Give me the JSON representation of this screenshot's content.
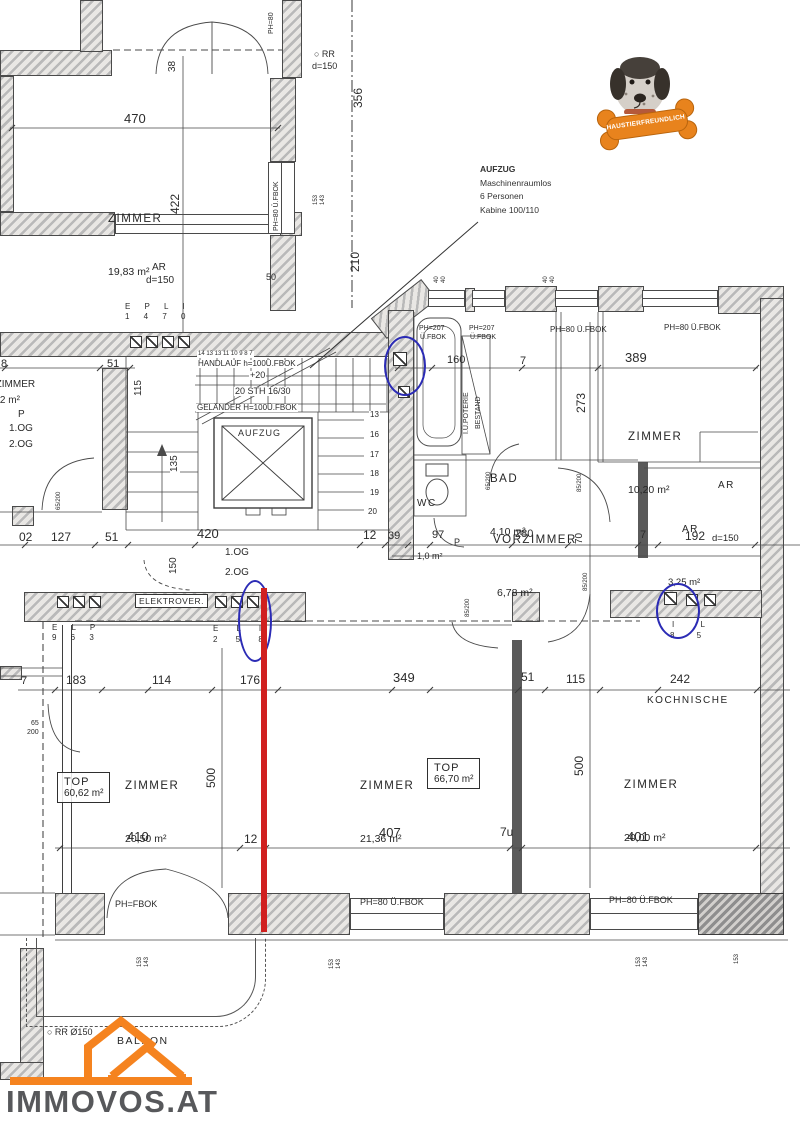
{
  "logo": {
    "text": "IMMOVOS.AT"
  },
  "badge": {
    "text": "HAUSTIERFREUNDLICH"
  },
  "note": {
    "l1": "AUFZUG",
    "l2": "Maschinenraumlos",
    "l3": "6 Personen",
    "l4": "Kabine 100/110"
  },
  "colors": {
    "highlight_red": "#d0201f",
    "circle_blue": "#2b2bb5",
    "logo_orange": "#f5831f",
    "logo_gray": "#57585b",
    "bone_orange": "#e8831d"
  },
  "rooms": {
    "zimmer_tl": {
      "name": "ZIMMER",
      "area": "19,83 m²"
    },
    "zimmer_r": {
      "name": "ZIMMER",
      "area": "10,20 m²"
    },
    "bad": {
      "name": "BAD",
      "area": "4,10 m²"
    },
    "wc": {
      "name": "WC",
      "area": "1,0 m²"
    },
    "vorzimmer": {
      "name": "VORZIMMER",
      "area": "6,78 m²"
    },
    "ar_top": {
      "name": "AR",
      "area": "d=150"
    },
    "ar_mid": {
      "name": "AR",
      "area": "3,25 m²"
    },
    "kochnische": {
      "name": "KOCHNISCHE"
    },
    "zimmer_bl": {
      "name": "ZIMMER",
      "area": "20,50 m²"
    },
    "top_unit_left": {
      "name": "TOP",
      "area": "60,62 m²"
    },
    "zimmer_bc": {
      "name": "ZIMMER",
      "area": "21,36 m²"
    },
    "top_unit_right": {
      "name": "TOP",
      "area": "66,70 m²"
    },
    "zimmer_br": {
      "name": "ZIMMER",
      "area": "20,00 m²"
    },
    "balkon": {
      "name": "BALKON"
    },
    "aufzug": {
      "name": "AUFZUG"
    },
    "elektro": {
      "name": "ELEKTROVER."
    }
  },
  "labels": [
    {
      "t": "470",
      "x": 124,
      "y": 112,
      "fs": 13
    },
    {
      "t": "38",
      "x": 168,
      "y": 72,
      "r": -90,
      "fs": 10
    },
    {
      "t": "422",
      "x": 169,
      "y": 214,
      "r": -90,
      "fs": 12
    },
    {
      "t": "○ RR",
      "x": 314,
      "y": 50,
      "fs": 9
    },
    {
      "t": "d=150",
      "x": 312,
      "y": 62,
      "fs": 9
    },
    {
      "t": "356",
      "x": 352,
      "y": 108,
      "r": -90,
      "fs": 12
    },
    {
      "t": "153",
      "x": 313,
      "y": 205,
      "r": -90,
      "fs": 6
    },
    {
      "t": "143",
      "x": 320,
      "y": 205,
      "r": -90,
      "fs": 6
    },
    {
      "t": "210",
      "x": 349,
      "y": 272,
      "r": -90,
      "fs": 12
    },
    {
      "t": "50",
      "x": 266,
      "y": 273,
      "fs": 9
    },
    {
      "t": "PH=80",
      "x": 268,
      "y": 34,
      "r": -90,
      "fs": 7
    },
    {
      "t": "PH=80 Ü.FBOK",
      "x": 273,
      "y": 232,
      "r": -90,
      "fs": 7,
      "bg": 1
    },
    {
      "t": "AR",
      "x": 152,
      "y": 263,
      "fs": 10
    },
    {
      "t": "d=150",
      "x": 146,
      "y": 276,
      "fs": 10
    },
    {
      "t": "E P L I",
      "x": 125,
      "y": 303,
      "fs": 8,
      "ls": 6
    },
    {
      "t": "1 4 7 0",
      "x": 125,
      "y": 313,
      "fs": 8,
      "ls": 6
    },
    {
      "t": "51",
      "x": 107,
      "y": 359,
      "fs": 11
    },
    {
      "t": "8",
      "x": 1,
      "y": 359,
      "fs": 11
    },
    {
      "t": "14 13 13 11 10 9 8 7",
      "x": 197,
      "y": 351,
      "fs": 6,
      "bg": 1
    },
    {
      "t": "HANDLAUF h=100Ü.FBOK",
      "x": 197,
      "y": 360,
      "fs": 8,
      "bg": 1
    },
    {
      "t": "+20",
      "x": 249,
      "y": 371,
      "fs": 9,
      "bg": 1
    },
    {
      "t": "20 STH 16/30",
      "x": 234,
      "y": 387,
      "fs": 9,
      "bg": 1
    },
    {
      "t": "GELÄNDER H=100Ü.FBOK",
      "x": 196,
      "y": 404,
      "fs": 8,
      "bg": 1
    },
    {
      "t": "115",
      "x": 134,
      "y": 397,
      "r": -90,
      "fs": 10,
      "bg": 1
    },
    {
      "t": "135",
      "x": 170,
      "y": 473,
      "r": -90,
      "fs": 10,
      "bg": 1
    },
    {
      "t": "13",
      "x": 369,
      "y": 411,
      "fs": 8,
      "bg": 1
    },
    {
      "t": "16",
      "x": 369,
      "y": 431,
      "fs": 8,
      "bg": 1
    },
    {
      "t": "17",
      "x": 369,
      "y": 451,
      "fs": 8,
      "bg": 1
    },
    {
      "t": "18",
      "x": 369,
      "y": 470,
      "fs": 8,
      "bg": 1
    },
    {
      "t": "19",
      "x": 369,
      "y": 489,
      "fs": 8,
      "bg": 1
    },
    {
      "t": "20",
      "x": 367,
      "y": 508,
      "fs": 8,
      "bg": 1
    },
    {
      "t": "PH=207",
      "x": 419,
      "y": 325,
      "fs": 7
    },
    {
      "t": "Ü.FBOK",
      "x": 420,
      "y": 334,
      "fs": 7
    },
    {
      "t": "PH=207",
      "x": 469,
      "y": 325,
      "fs": 7
    },
    {
      "t": "Ü.FBOK",
      "x": 470,
      "y": 334,
      "fs": 7
    },
    {
      "t": "PH=80 Ü.FBOK",
      "x": 550,
      "y": 326,
      "fs": 8
    },
    {
      "t": "PH=80 Ü.FBOK",
      "x": 664,
      "y": 324,
      "fs": 8
    },
    {
      "t": "160",
      "x": 447,
      "y": 355,
      "fs": 11
    },
    {
      "t": "7",
      "x": 520,
      "y": 356,
      "fs": 11
    },
    {
      "t": "389",
      "x": 625,
      "y": 351,
      "fs": 13
    },
    {
      "t": "273",
      "x": 575,
      "y": 413,
      "r": -90,
      "fs": 12
    },
    {
      "t": "I.Ü.POTERIE",
      "x": 463,
      "y": 434,
      "r": -90,
      "fs": 7
    },
    {
      "t": "BESTAND",
      "x": 475,
      "y": 429,
      "r": -90,
      "fs": 7
    },
    {
      "t": "40",
      "x": 434,
      "y": 283,
      "r": -90,
      "fs": 6
    },
    {
      "t": "40",
      "x": 441,
      "y": 283,
      "r": -90,
      "fs": 6
    },
    {
      "t": "40",
      "x": 543,
      "y": 283,
      "r": -90,
      "fs": 6
    },
    {
      "t": "40",
      "x": 550,
      "y": 283,
      "r": -90,
      "fs": 6
    },
    {
      "t": "85/200",
      "x": 577,
      "y": 492,
      "r": -90,
      "fs": 6
    },
    {
      "t": "65/200",
      "x": 486,
      "y": 490,
      "r": -90,
      "fs": 6
    },
    {
      "t": "85/200",
      "x": 583,
      "y": 592,
      "r": -90,
      "fs": 6,
      "bg": 1
    },
    {
      "t": "85/200",
      "x": 465,
      "y": 617,
      "r": -90,
      "fs": 6
    },
    {
      "t": "65/200",
      "x": 56,
      "y": 510,
      "r": -90,
      "fs": 6
    },
    {
      "t": "65",
      "x": 31,
      "y": 720,
      "fs": 7
    },
    {
      "t": "200",
      "x": 27,
      "y": 729,
      "fs": 7
    },
    {
      "t": "02",
      "x": 19,
      "y": 531,
      "fs": 12
    },
    {
      "t": "127",
      "x": 51,
      "y": 531,
      "fs": 12
    },
    {
      "t": "51",
      "x": 105,
      "y": 531,
      "fs": 12
    },
    {
      "t": "420",
      "x": 197,
      "y": 527,
      "fs": 13
    },
    {
      "t": "12",
      "x": 363,
      "y": 529,
      "fs": 12
    },
    {
      "t": "39",
      "x": 388,
      "y": 531,
      "fs": 11
    },
    {
      "t": "97",
      "x": 432,
      "y": 530,
      "fs": 11
    },
    {
      "t": "P",
      "x": 454,
      "y": 538,
      "fs": 9
    },
    {
      "t": "280",
      "x": 515,
      "y": 529,
      "fs": 11
    },
    {
      "t": "70",
      "x": 575,
      "y": 544,
      "r": -90,
      "fs": 10
    },
    {
      "t": "7",
      "x": 640,
      "y": 530,
      "fs": 11
    },
    {
      "t": "192",
      "x": 685,
      "y": 530,
      "fs": 12
    },
    {
      "t": "150",
      "x": 169,
      "y": 574,
      "r": -90,
      "fs": 10
    },
    {
      "t": "1.OG",
      "x": 225,
      "y": 548,
      "fs": 10
    },
    {
      "t": "2.OG",
      "x": 225,
      "y": 568,
      "fs": 10
    },
    {
      "t": "VORZIMMER",
      "x": -26,
      "y": 380,
      "fs": 10
    },
    {
      "t": "4,02 m²",
      "x": -14,
      "y": 396,
      "fs": 10
    },
    {
      "t": "P",
      "x": 18,
      "y": 410,
      "fs": 10
    },
    {
      "t": "1.OG",
      "x": 9,
      "y": 424,
      "fs": 10
    },
    {
      "t": "2.OG",
      "x": 9,
      "y": 440,
      "fs": 10
    },
    {
      "t": "E L P",
      "x": 52,
      "y": 624,
      "fs": 8,
      "ls": 6
    },
    {
      "t": "9 6 3",
      "x": 52,
      "y": 634,
      "fs": 8,
      "ls": 6
    },
    {
      "t": "E L I",
      "x": 213,
      "y": 625,
      "fs": 8,
      "ls": 8
    },
    {
      "t": "2 5 8",
      "x": 213,
      "y": 636,
      "fs": 8,
      "ls": 8
    },
    {
      "t": "I L",
      "x": 672,
      "y": 621,
      "fs": 8,
      "ls": 12
    },
    {
      "t": "8 5",
      "x": 670,
      "y": 632,
      "fs": 8,
      "ls": 10
    },
    {
      "t": "7",
      "x": 21,
      "y": 676,
      "fs": 11
    },
    {
      "t": "183",
      "x": 66,
      "y": 674,
      "fs": 12
    },
    {
      "t": "114",
      "x": 152,
      "y": 674,
      "fs": 12
    },
    {
      "t": "176",
      "x": 240,
      "y": 674,
      "fs": 12
    },
    {
      "t": "349",
      "x": 393,
      "y": 671,
      "fs": 13
    },
    {
      "t": "51",
      "x": 521,
      "y": 671,
      "fs": 12
    },
    {
      "t": "115",
      "x": 566,
      "y": 673,
      "fs": 12
    },
    {
      "t": "242",
      "x": 670,
      "y": 673,
      "fs": 12
    },
    {
      "t": "410",
      "x": 127,
      "y": 830,
      "fs": 13
    },
    {
      "t": "12",
      "x": 244,
      "y": 833,
      "fs": 12
    },
    {
      "t": "407",
      "x": 379,
      "y": 826,
      "fs": 13
    },
    {
      "t": "7u",
      "x": 500,
      "y": 826,
      "fs": 12
    },
    {
      "t": "401",
      "x": 627,
      "y": 830,
      "fs": 13
    },
    {
      "t": "500",
      "x": 205,
      "y": 789,
      "r": -90,
      "fs": 12,
      "bg": 1
    },
    {
      "t": "500",
      "x": 573,
      "y": 777,
      "r": -90,
      "fs": 12,
      "bg": 1
    },
    {
      "t": "PH=FBOK",
      "x": 115,
      "y": 900,
      "fs": 9
    },
    {
      "t": "PH=80 Ü.FBOK",
      "x": 360,
      "y": 898,
      "fs": 9
    },
    {
      "t": "PH=80 Ü.FBOK",
      "x": 609,
      "y": 896,
      "fs": 9
    },
    {
      "t": "153",
      "x": 137,
      "y": 967,
      "r": -90,
      "fs": 6
    },
    {
      "t": "143",
      "x": 144,
      "y": 967,
      "r": -90,
      "fs": 6
    },
    {
      "t": "153",
      "x": 329,
      "y": 969,
      "r": -90,
      "fs": 6
    },
    {
      "t": "143",
      "x": 336,
      "y": 969,
      "r": -90,
      "fs": 6
    },
    {
      "t": "153",
      "x": 636,
      "y": 967,
      "r": -90,
      "fs": 6
    },
    {
      "t": "143",
      "x": 643,
      "y": 967,
      "r": -90,
      "fs": 6
    },
    {
      "t": "153",
      "x": 734,
      "y": 964,
      "r": -90,
      "fs": 6
    },
    {
      "t": "○ RR Ø150",
      "x": 47,
      "y": 1028,
      "fs": 9
    }
  ]
}
